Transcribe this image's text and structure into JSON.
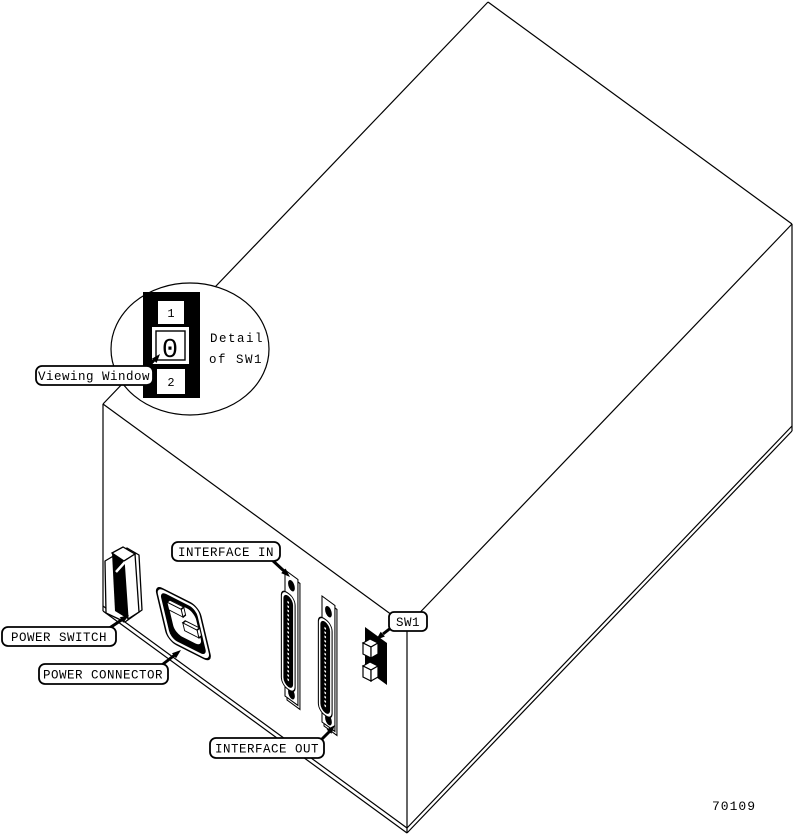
{
  "figure_number": "70109",
  "callouts": {
    "viewing_window": "Viewing Window",
    "power_switch": "POWER SWITCH",
    "power_connector": "POWER CONNECTOR",
    "interface_in": "INTERFACE IN",
    "interface_out": "INTERFACE OUT",
    "sw1": "SW1"
  },
  "detail_inset": {
    "caption_line1": "Detail",
    "caption_line2": "of SW1",
    "position_top": "1",
    "window_value": "0",
    "position_bottom": "2"
  },
  "colors": {
    "line": "#000000",
    "background": "#ffffff"
  }
}
